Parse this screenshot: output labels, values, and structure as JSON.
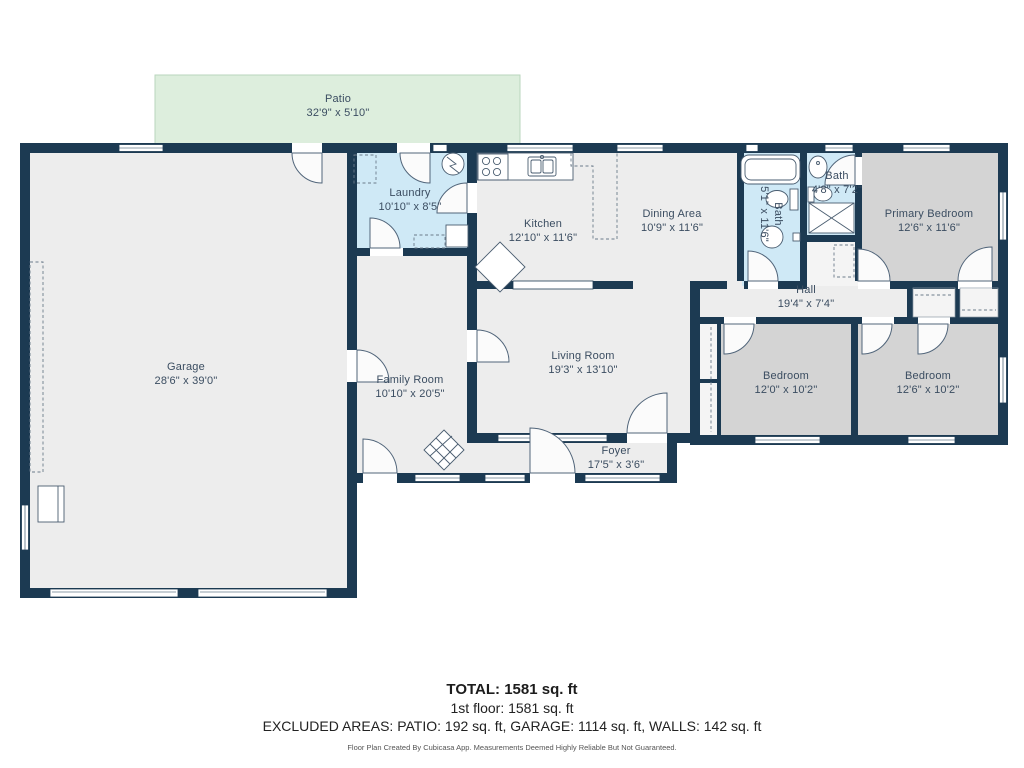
{
  "rooms": [
    {
      "id": "patio",
      "name": "Patio",
      "dims": "32'9\" x 5'10\""
    },
    {
      "id": "garage",
      "name": "Garage",
      "dims": "28'6\" x 39'0\""
    },
    {
      "id": "laundry",
      "name": "Laundry",
      "dims": "10'10\" x 8'5\""
    },
    {
      "id": "kitchen",
      "name": "Kitchen",
      "dims": "12'10\" x 11'6\""
    },
    {
      "id": "dining",
      "name": "Dining Area",
      "dims": "10'9\" x 11'6\""
    },
    {
      "id": "bath1",
      "name": "Bath",
      "dims": "5'1\" x 11'6\""
    },
    {
      "id": "bath2",
      "name": "Bath",
      "dims": "4'8\" x 7'2\""
    },
    {
      "id": "primary",
      "name": "Primary Bedroom",
      "dims": "12'6\" x 11'6\""
    },
    {
      "id": "hall",
      "name": "Hall",
      "dims": "19'4\" x 7'4\""
    },
    {
      "id": "family",
      "name": "Family Room",
      "dims": "10'10\" x 20'5\""
    },
    {
      "id": "living",
      "name": "Living Room",
      "dims": "19'3\" x 13'10\""
    },
    {
      "id": "foyer",
      "name": "Foyer",
      "dims": "17'5\" x 3'6\""
    },
    {
      "id": "bedroom1",
      "name": "Bedroom",
      "dims": "12'0\" x 10'2\""
    },
    {
      "id": "bedroom2",
      "name": "Bedroom",
      "dims": "12'6\" x 10'2\""
    }
  ],
  "summary": {
    "total": "TOTAL: 1581 sq. ft",
    "floor1": "1st floor: 1581 sq. ft",
    "excluded": "EXCLUDED AREAS: PATIO: 192 sq. ft, GARAGE: 1114 sq. ft, WALLS: 142 sq. ft",
    "disclaimer": "Floor Plan Created By Cubicasa App. Measurements Deemed Highly Reliable But Not Guaranteed."
  },
  "colors": {
    "wall": "#1c3a52",
    "floor": "#ededed",
    "bedroom_floor": "#d4d4d4",
    "wet_room": "#cfe9f6",
    "patio": "#ddeedd",
    "label_text": "#3b4d61"
  }
}
